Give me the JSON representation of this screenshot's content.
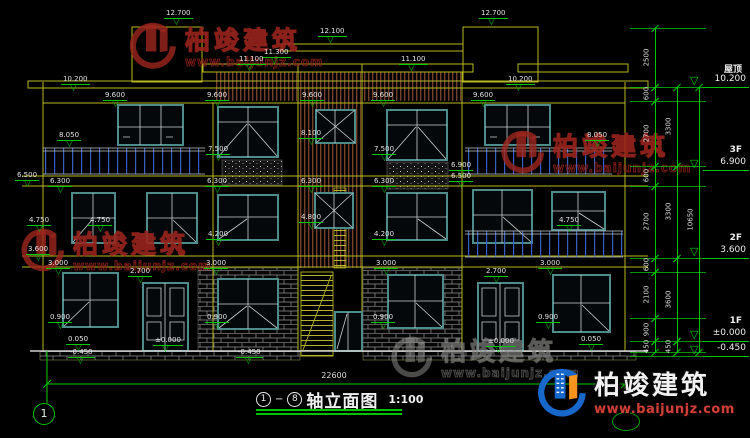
{
  "title": {
    "axis_start": "1",
    "axis_end": "8",
    "text": "轴立面图",
    "scale": "1:100"
  },
  "axis_bubble": "1",
  "ground": {
    "overall_width": "22600"
  },
  "watermark": {
    "brand": "柏竣建筑",
    "url": "www.baijunjz.com"
  },
  "logo": {
    "brand": "柏竣建筑",
    "url": "www.baijunjz.com"
  },
  "floor_levels": [
    {
      "label": "屋顶",
      "elevation": "10.200",
      "y": 87
    },
    {
      "label": "3F",
      "elevation": "6.900",
      "y": 170
    },
    {
      "label": "2F",
      "elevation": "3.600",
      "y": 258
    },
    {
      "label": "1F",
      "elevation": "±0.000",
      "y": 341
    },
    {
      "label": "",
      "elevation": "-0.450",
      "y": 356
    }
  ],
  "dim_chains": [
    {
      "x": 655,
      "segments": [
        {
          "label": "2500",
          "y1": 28,
          "y2": 87
        },
        {
          "label": "600",
          "y1": 87,
          "y2": 101
        },
        {
          "label": "2700",
          "y1": 101,
          "y2": 166
        },
        {
          "label": "600",
          "y1": 166,
          "y2": 186
        },
        {
          "label": "2700",
          "y1": 186,
          "y2": 258
        },
        {
          "label": "600",
          "y1": 258,
          "y2": 272
        },
        {
          "label": "2100",
          "y1": 272,
          "y2": 318
        },
        {
          "label": "900",
          "y1": 318,
          "y2": 341
        },
        {
          "label": "450",
          "y1": 341,
          "y2": 352
        }
      ]
    },
    {
      "x": 677,
      "segments": [
        {
          "label": "3300",
          "y1": 87,
          "y2": 166
        },
        {
          "label": "3300",
          "y1": 166,
          "y2": 258
        },
        {
          "label": "3600",
          "y1": 258,
          "y2": 341
        },
        {
          "label": "450",
          "y1": 341,
          "y2": 352
        }
      ]
    },
    {
      "x": 699,
      "segments": [
        {
          "label": "10650",
          "y1": 87,
          "y2": 352
        }
      ]
    }
  ],
  "tick_lines": [
    28,
    87,
    101,
    166,
    186,
    258,
    272,
    318,
    341,
    352,
    356
  ],
  "elevation_markers": [
    {
      "label": "12.700",
      "x": 164,
      "y": 9
    },
    {
      "label": "12.700",
      "x": 479,
      "y": 9
    },
    {
      "label": "12.100",
      "x": 318,
      "y": 27
    },
    {
      "label": "11.300",
      "x": 262,
      "y": 48
    },
    {
      "label": "11.100",
      "x": 237,
      "y": 55
    },
    {
      "label": "11.100",
      "x": 399,
      "y": 55
    },
    {
      "label": "10.200",
      "x": 61,
      "y": 75
    },
    {
      "label": "10.200",
      "x": 506,
      "y": 75
    },
    {
      "label": "9.600",
      "x": 103,
      "y": 91
    },
    {
      "label": "9.600",
      "x": 205,
      "y": 91
    },
    {
      "label": "9.600",
      "x": 300,
      "y": 91
    },
    {
      "label": "9.600",
      "x": 371,
      "y": 91
    },
    {
      "label": "9.600",
      "x": 471,
      "y": 91
    },
    {
      "label": "8.050",
      "x": 57,
      "y": 131
    },
    {
      "label": "8.050",
      "x": 585,
      "y": 131
    },
    {
      "label": "8.100",
      "x": 299,
      "y": 129
    },
    {
      "label": "7.500",
      "x": 206,
      "y": 145
    },
    {
      "label": "7.500",
      "x": 372,
      "y": 145
    },
    {
      "label": "6.900",
      "x": 449,
      "y": 161
    },
    {
      "label": "6.500",
      "x": 15,
      "y": 171
    },
    {
      "label": "6.500",
      "x": 449,
      "y": 172
    },
    {
      "label": "6.300",
      "x": 48,
      "y": 177
    },
    {
      "label": "6.300",
      "x": 205,
      "y": 177
    },
    {
      "label": "6.300",
      "x": 299,
      "y": 177
    },
    {
      "label": "6.300",
      "x": 372,
      "y": 177
    },
    {
      "label": "4.800",
      "x": 299,
      "y": 213
    },
    {
      "label": "4.750",
      "x": 27,
      "y": 216
    },
    {
      "label": "4.750",
      "x": 88,
      "y": 216
    },
    {
      "label": "4.750",
      "x": 557,
      "y": 216
    },
    {
      "label": "4.200",
      "x": 206,
      "y": 230
    },
    {
      "label": "4.200",
      "x": 372,
      "y": 230
    },
    {
      "label": "3.600",
      "x": 26,
      "y": 245
    },
    {
      "label": "3.000",
      "x": 46,
      "y": 259
    },
    {
      "label": "3.000",
      "x": 204,
      "y": 259
    },
    {
      "label": "3.000",
      "x": 374,
      "y": 259
    },
    {
      "label": "3.000",
      "x": 538,
      "y": 259
    },
    {
      "label": "2.700",
      "x": 128,
      "y": 267
    },
    {
      "label": "2.700",
      "x": 484,
      "y": 267
    },
    {
      "label": "0.900",
      "x": 48,
      "y": 313
    },
    {
      "label": "0.900",
      "x": 205,
      "y": 313
    },
    {
      "label": "0.900",
      "x": 371,
      "y": 313
    },
    {
      "label": "0.900",
      "x": 536,
      "y": 313
    },
    {
      "label": "0.050",
      "x": 66,
      "y": 335
    },
    {
      "label": "0.050",
      "x": 579,
      "y": 335
    },
    {
      "label": "±0.000",
      "x": 153,
      "y": 336
    },
    {
      "label": "±0.000",
      "x": 486,
      "y": 337
    },
    {
      "label": "-0.450",
      "x": 68,
      "y": 348
    },
    {
      "label": "-0.450",
      "x": 236,
      "y": 348
    }
  ]
}
